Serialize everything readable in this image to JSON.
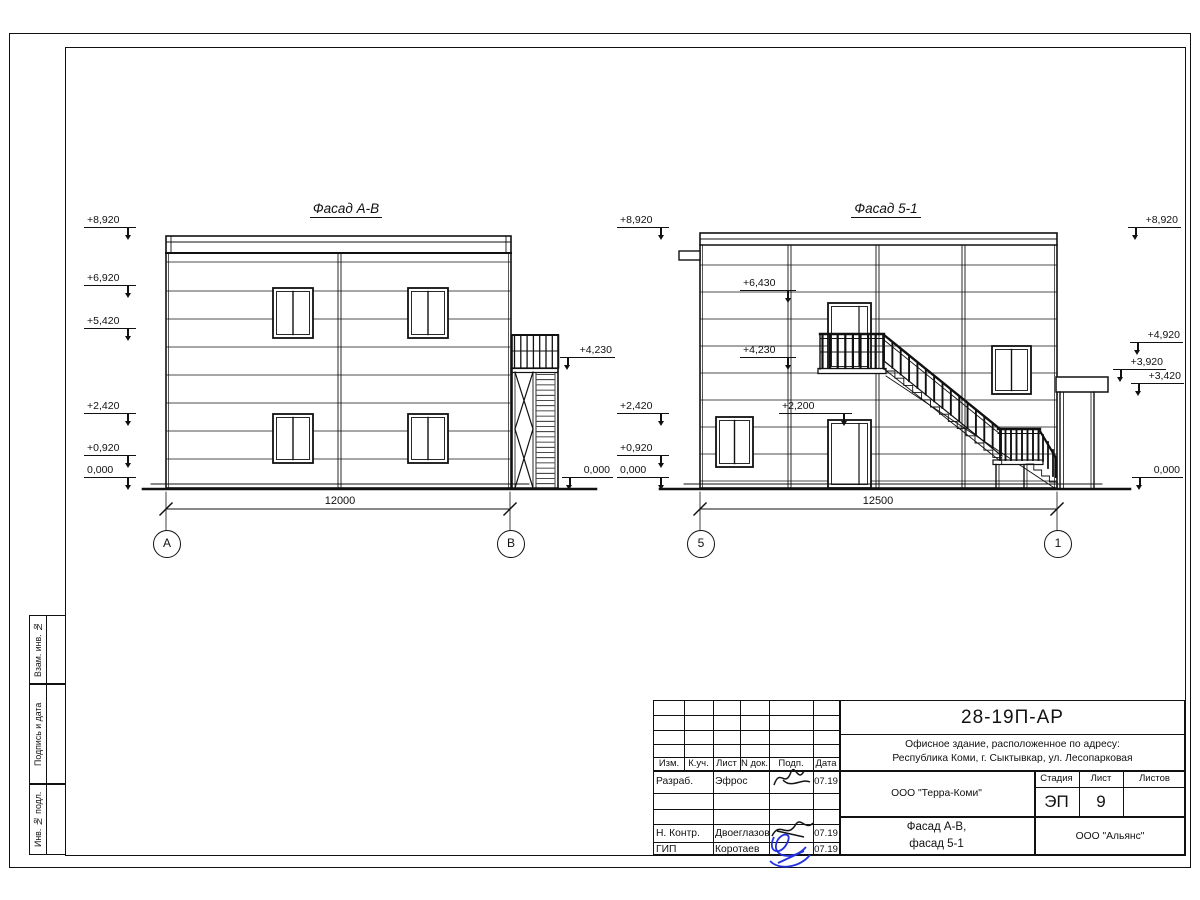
{
  "drawing": {
    "facade_ab": {
      "title": "Фасад А-В",
      "marks_left": [
        "+8,920",
        "+6,920",
        "+5,420",
        "+2,420",
        "+0,920",
        "0,000"
      ],
      "mark_stair_top": "+4,230",
      "mark_right_zero": "0,000",
      "dimension": "12000",
      "axis_a": "А",
      "axis_b": "В"
    },
    "facade_51": {
      "title": "Фасад 5-1",
      "marks_left": [
        "+8,920",
        "+2,420",
        "+0,920",
        "0,000"
      ],
      "marks_inner": [
        "+6,430",
        "+4,230",
        "+2,200"
      ],
      "marks_right": [
        "+8,920",
        "+4,920",
        "+3,920",
        "+3,420",
        "0,000"
      ],
      "dimension": "12500",
      "axis_5": "5",
      "axis_1": "1"
    }
  },
  "side_stamp": {
    "labels": [
      "Взам. инв. №",
      "Подпись и дата",
      "Инв. № подл."
    ]
  },
  "title_block": {
    "doc_code": "28-19П-АР",
    "object_line1": "Офисное здание, расположенное по адресу:",
    "object_line2": "Республика Коми, г. Сыктывкар, ул. Лесопарковая",
    "cols": {
      "izm": "Изм.",
      "kuch": "К.уч.",
      "list": "Лист",
      "ndok": "N док.",
      "podp": "Подп.",
      "data": "Дата"
    },
    "rows": [
      {
        "role": "Разраб.",
        "name": "Эфрос",
        "date": "07.19"
      },
      {
        "role": "Н. Контр.",
        "name": "Двоеглазов",
        "date": "07.19"
      },
      {
        "role": "ГИП",
        "name": "Коротаев",
        "date": "07.19"
      }
    ],
    "org": "ООО \"Терра-Коми\"",
    "stage_label": "Стадия",
    "sheet_label": "Лист",
    "sheets_label": "Листов",
    "stage": "ЭП",
    "sheet": "9",
    "sheet_title_line1": "Фасад А-В,",
    "sheet_title_line2": "фасад 5-1",
    "contractor": "ООО \"Альянс\""
  }
}
